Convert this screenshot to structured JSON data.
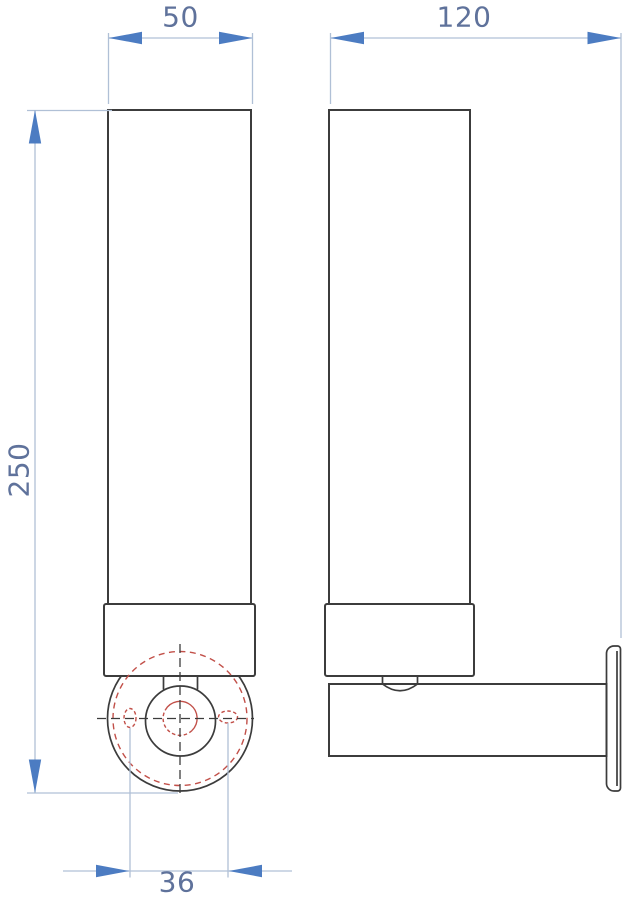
{
  "dimensions": {
    "front_width": {
      "value": "50"
    },
    "side_depth": {
      "value": "120"
    },
    "overall_height": {
      "value": "250"
    },
    "mounting_hole_spacing": {
      "value": "36"
    }
  },
  "colors": {
    "background": "#ffffff",
    "line_dark": "#3c3c3c",
    "hidden_detail_red": "#c25049",
    "dimension_line": "#b0c0d6",
    "dimension_arrow": "#4c7cc2",
    "dimension_text": "#5f729b"
  }
}
